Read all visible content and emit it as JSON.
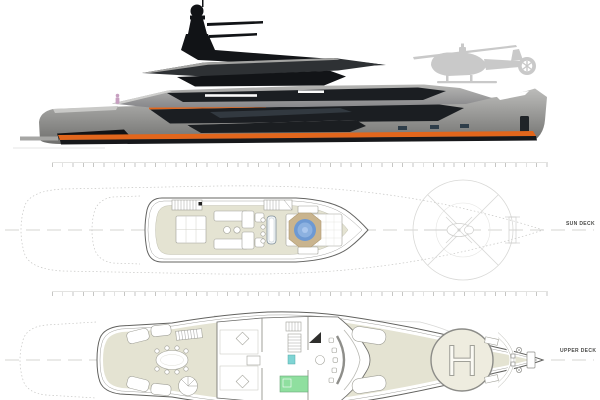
{
  "document": {
    "kind": "yacht-general-arrangement-drawing"
  },
  "labels": {
    "sun_deck": "SUN DECK",
    "upper_deck": "UPPER DECK",
    "helipad_letter": "H"
  },
  "colors": {
    "background": "#ffffff",
    "hull-gray": "#90918f",
    "glass-dark": "#1b1e22",
    "accent-orange": "#e2661c",
    "ghost-gray": "#c9c9c9",
    "deck-beige": "#e4e3d2",
    "jacuzzi-blue": "#6d99d3",
    "jacuzzi-rim": "#c9b48e",
    "green-room": "#8fdf9f",
    "teal-fixture": "#7fd4d4"
  },
  "views": [
    {
      "name": "side-profile-render",
      "features": [
        "mast-radar-array",
        "helicopter-silhouette",
        "orange-waterline-stripe",
        "swim-platform"
      ]
    },
    {
      "name": "sun-deck-plan",
      "label": "SUN DECK",
      "features": [
        "stairs",
        "sunbed",
        "sofa-group",
        "bar-with-stools",
        "jacuzzi",
        "sunpads",
        "helicopter-clearance-circle"
      ]
    },
    {
      "name": "upper-deck-plan",
      "label": "UPPER DECK",
      "features": [
        "aft-dining-table",
        "spiral-stair",
        "salon-sofas",
        "stair-lobby",
        "pantry-green-room",
        "wheelhouse-console",
        "helipad",
        "anchor-windlass"
      ]
    }
  ]
}
